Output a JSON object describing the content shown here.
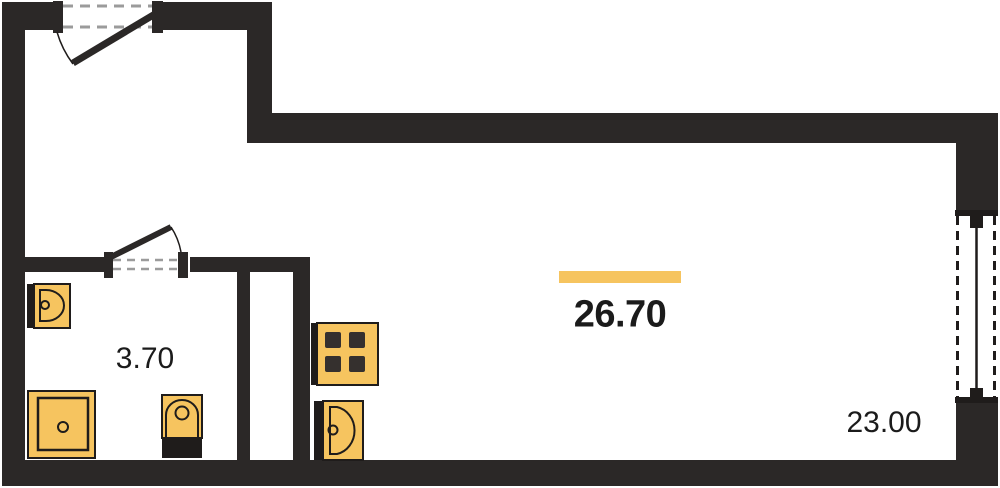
{
  "labels": {
    "total_area": "26.70",
    "bathroom_area": "3.70",
    "living_area": "23.00"
  },
  "colors": {
    "accent": "#F6C45F",
    "wall": "#2B2827",
    "line": "#1F1C1B",
    "dash": "#9B9B9B",
    "burner": "#35302E",
    "text": "#1B1B1B",
    "bg": "#FFFFFF"
  },
  "fixtures": [
    "washbasin-icon",
    "shower-icon",
    "toilet-icon",
    "stove-icon",
    "kitchen-sink-icon"
  ],
  "openings": [
    "entrance-door",
    "bathroom-door",
    "window"
  ]
}
